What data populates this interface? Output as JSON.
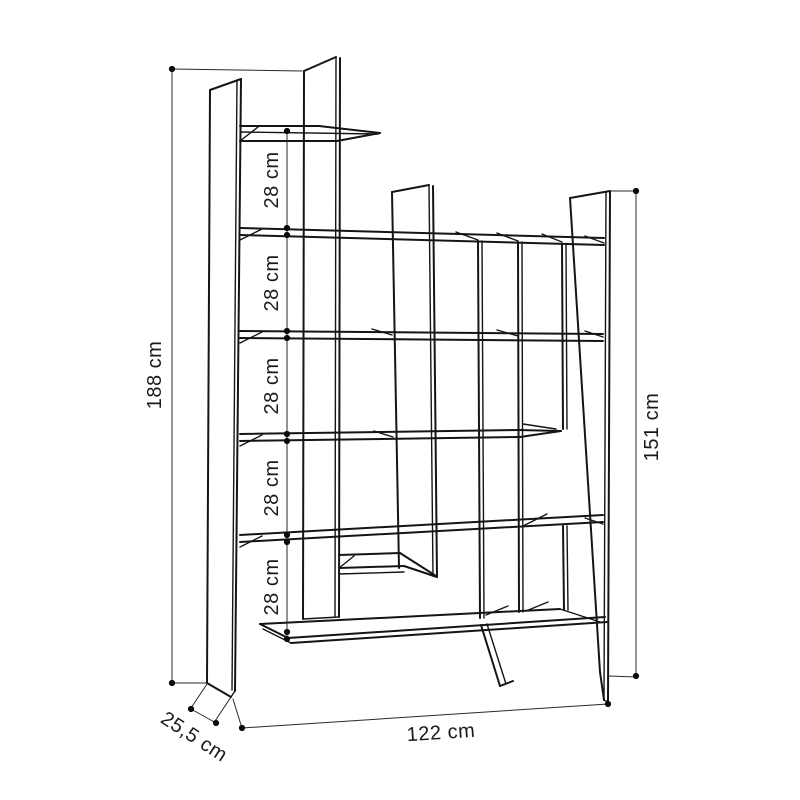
{
  "page": {
    "background": "#ffffff"
  },
  "drawing": {
    "subject": "staggered bookcase dimensional drawing",
    "unit": "cm",
    "line_color": "#151515",
    "dimension_labels": {
      "overall_height": "188 cm",
      "inner_height": "151 cm",
      "overall_width": "122 cm",
      "depth": "25,5 cm"
    },
    "shelf_gap_labels": [
      "28 cm",
      "28 cm",
      "28 cm",
      "28 cm",
      "28 cm"
    ]
  }
}
